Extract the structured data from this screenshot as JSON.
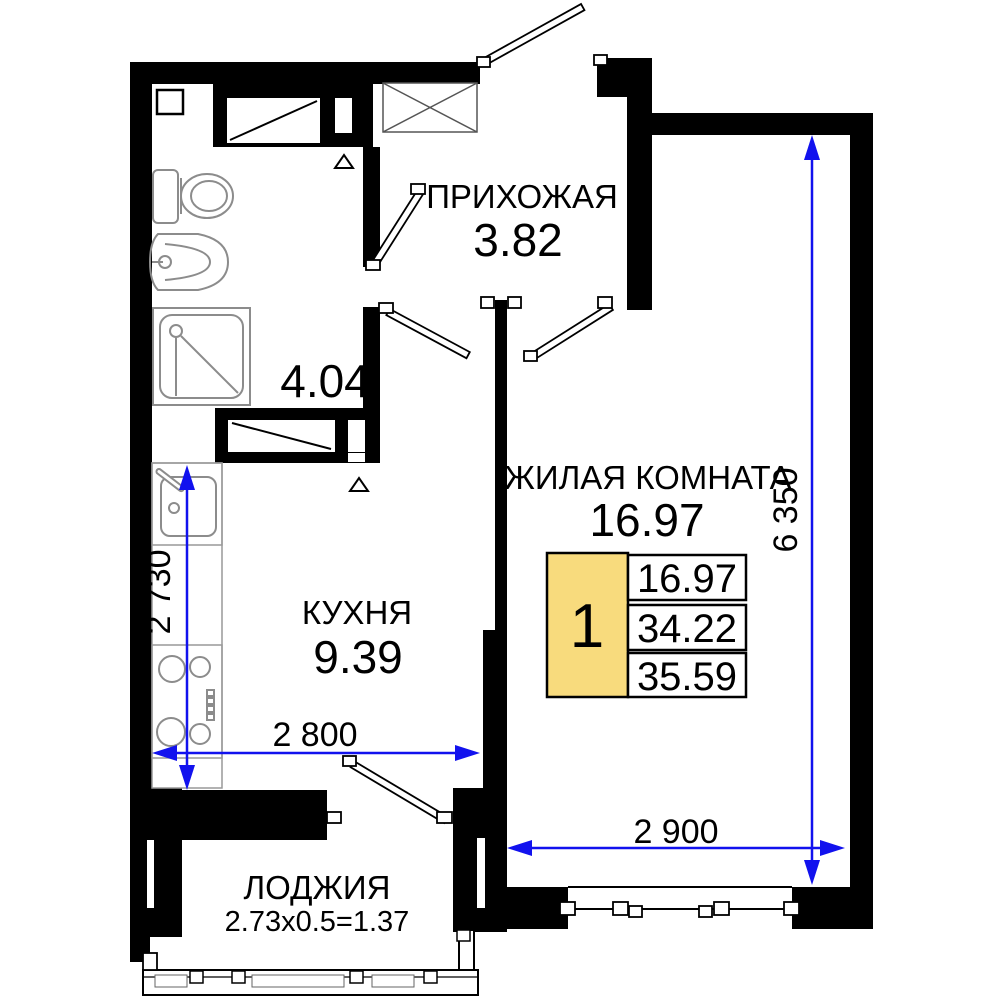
{
  "rooms": {
    "hallway": {
      "name": "ПРИХОЖАЯ",
      "area": "3.82"
    },
    "bathroom": {
      "area": "4.04"
    },
    "living": {
      "name": "ЖИЛАЯ КОМНАТА",
      "area": "16.97"
    },
    "kitchen": {
      "name": "КУХНЯ",
      "area": "9.39"
    },
    "loggia": {
      "name": "ЛОДЖИЯ",
      "area": "2.73x0.5=1.37"
    }
  },
  "dimensions": {
    "right_vertical": "6 350",
    "kitchen_vertical": "2 730",
    "kitchen_horizontal": "2 800",
    "living_horizontal": "2 900"
  },
  "info_box": {
    "rooms_count": "1",
    "living_area": "16.97",
    "area_no_loggia": "34.22",
    "total_area": "35.59"
  },
  "colors": {
    "dimension_blue": "#1212EE",
    "info_yellow": "#F8DB7D",
    "wall_black": "#000000",
    "fixture_gray": "#8C8C8C"
  }
}
